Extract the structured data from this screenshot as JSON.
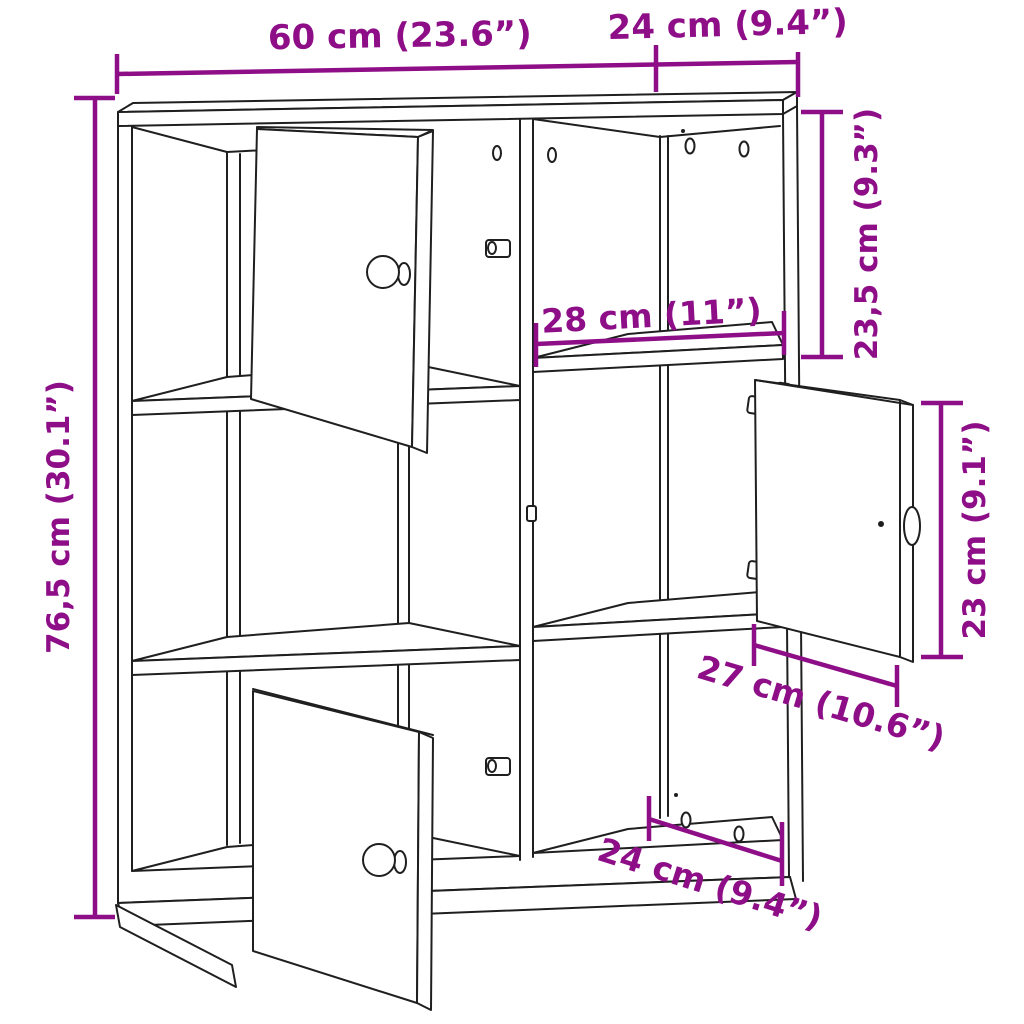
{
  "diagram": {
    "type": "furniture dimension drawing",
    "subject": "six-compartment bookcase cabinet with three open doors",
    "colors": {
      "lines": "#1f1f1f",
      "dimensions": "#8e0e88",
      "background": "#ffffff"
    },
    "dimensions": {
      "total_width": "60 cm (23.6”)",
      "top_depth": "24 cm (9.4”)",
      "top_compartment_height": "23,5 cm (9.3”)",
      "compartment_width": "28 cm (11”)",
      "total_height": "76,5 cm (30.1”)",
      "door_height": "23 cm (9.1”)",
      "door_width": "27 cm (10.6”)",
      "bottom_depth": "24 cm (9.4”)"
    }
  }
}
